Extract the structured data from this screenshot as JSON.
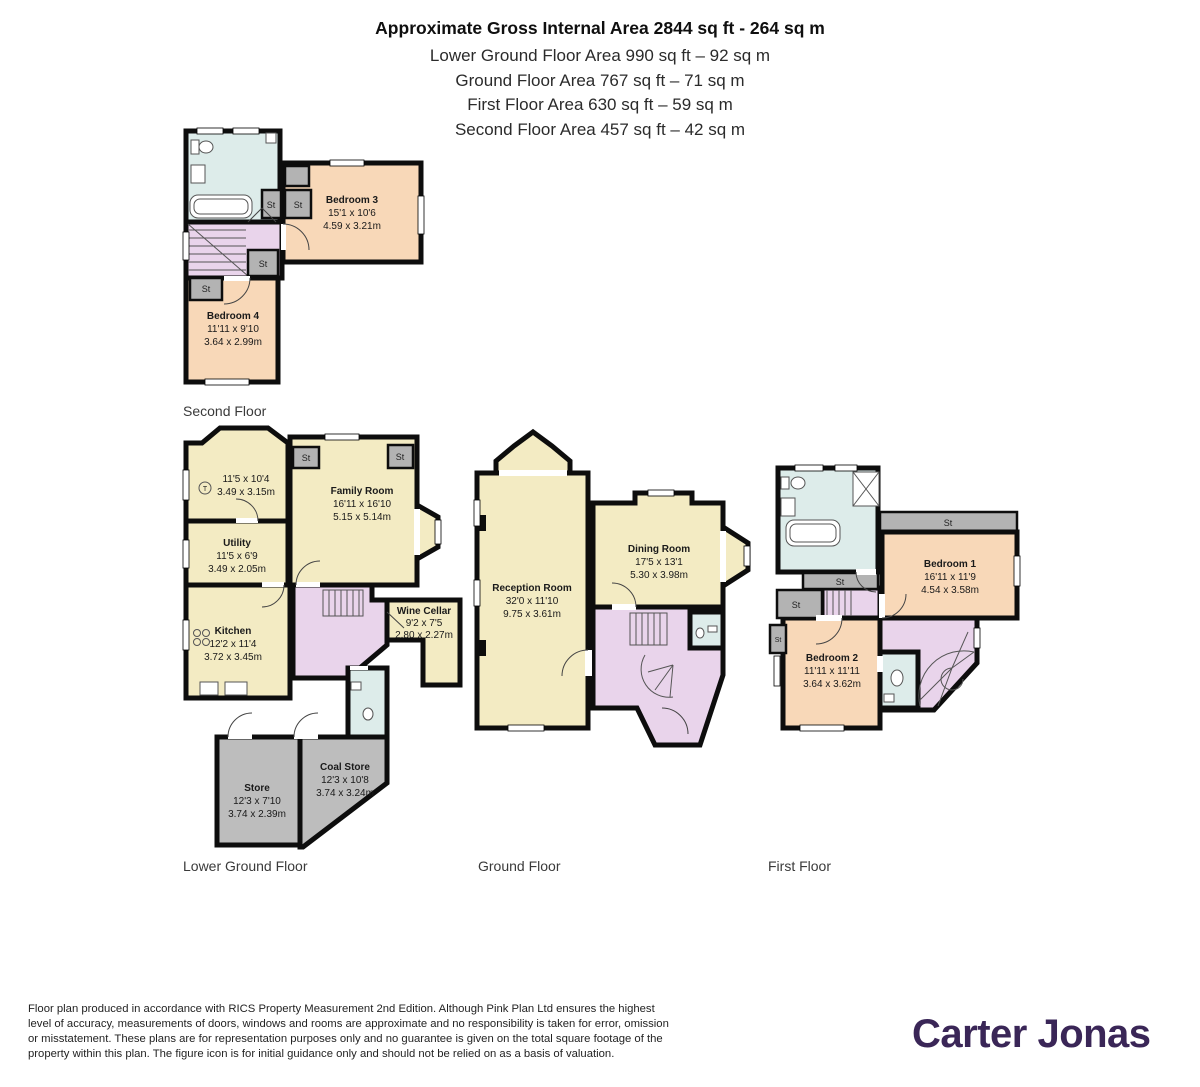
{
  "header": {
    "title": "Approximate Gross Internal Area 2844 sq ft - 264 sq m",
    "subtitles": [
      "Lower Ground Floor Area 990 sq ft – 92 sq m",
      "Ground Floor Area 767 sq ft – 71 sq m",
      "First Floor Area 630 sq ft – 59 sq m",
      "Second Floor Area 457 sq ft – 42 sq m"
    ]
  },
  "labels": {
    "storage": "St",
    "tumble": "T"
  },
  "floors": {
    "second": {
      "caption": "Second Floor",
      "rooms": {
        "bedroom3": {
          "name": "Bedroom 3",
          "dims_ft": "15'1 x 10'6",
          "dims_m": "4.59 x 3.21m"
        },
        "bedroom4": {
          "name": "Bedroom 4",
          "dims_ft": "11'11 x 9'10",
          "dims_m": "3.64 x 2.99m"
        }
      }
    },
    "lower_ground": {
      "caption": "Lower Ground Floor",
      "rooms": {
        "room_t": {
          "dims_ft": "11'5 x 10'4",
          "dims_m": "3.49 x 3.15m"
        },
        "utility": {
          "name": "Utility",
          "dims_ft": "11'5 x 6'9",
          "dims_m": "3.49 x 2.05m"
        },
        "kitchen": {
          "name": "Kitchen",
          "dims_ft": "12'2 x 11'4",
          "dims_m": "3.72 x 3.45m"
        },
        "family_room": {
          "name": "Family Room",
          "dims_ft": "16'11 x 16'10",
          "dims_m": "5.15 x 5.14m"
        },
        "wine_cellar": {
          "name": "Wine Cellar",
          "dims_ft": "9'2 x 7'5",
          "dims_m": "2.80 x 2.27m"
        },
        "store": {
          "name": "Store",
          "dims_ft": "12'3 x 7'10",
          "dims_m": "3.74 x 2.39m"
        },
        "coal_store": {
          "name": "Coal Store",
          "dims_ft": "12'3 x 10'8",
          "dims_m": "3.74 x 3.24m"
        }
      }
    },
    "ground": {
      "caption": "Ground Floor",
      "rooms": {
        "reception": {
          "name": "Reception Room",
          "dims_ft": "32'0 x 11'10",
          "dims_m": "9.75 x 3.61m"
        },
        "dining": {
          "name": "Dining Room",
          "dims_ft": "17'5 x 13'1",
          "dims_m": "5.30 x 3.98m"
        }
      }
    },
    "first": {
      "caption": "First Floor",
      "rooms": {
        "bedroom1": {
          "name": "Bedroom 1",
          "dims_ft": "16'11 x 11'9",
          "dims_m": "4.54 x 3.58m"
        },
        "bedroom2": {
          "name": "Bedroom 2",
          "dims_ft": "11'11 x 11'11",
          "dims_m": "3.64 x 3.62m"
        }
      }
    }
  },
  "footer": {
    "lines": [
      "Floor plan produced in accordance with RICS Property Measurement 2nd Edition. Although Pink Plan Ltd ensures the highest",
      "level of accuracy, measurements of doors, windows and rooms are approximate and no responsibility is taken for error, omission",
      "or misstatement. These plans are for representation purposes only and no guarantee is given on the total square footage of the",
      "property within this plan. The figure icon is for initial guidance only and should not be relied on as a basis of valuation."
    ],
    "brand": "Carter Jonas"
  },
  "colors": {
    "wall": "#0d0d0d",
    "bedroom_fill": "#f8d8b8",
    "living_fill": "#f3ebc3",
    "hall_fill": "#e9d4eb",
    "bath_fill": "#ddecea",
    "store_fill": "#bdbdbd",
    "brand_purple": "#3a2657"
  }
}
